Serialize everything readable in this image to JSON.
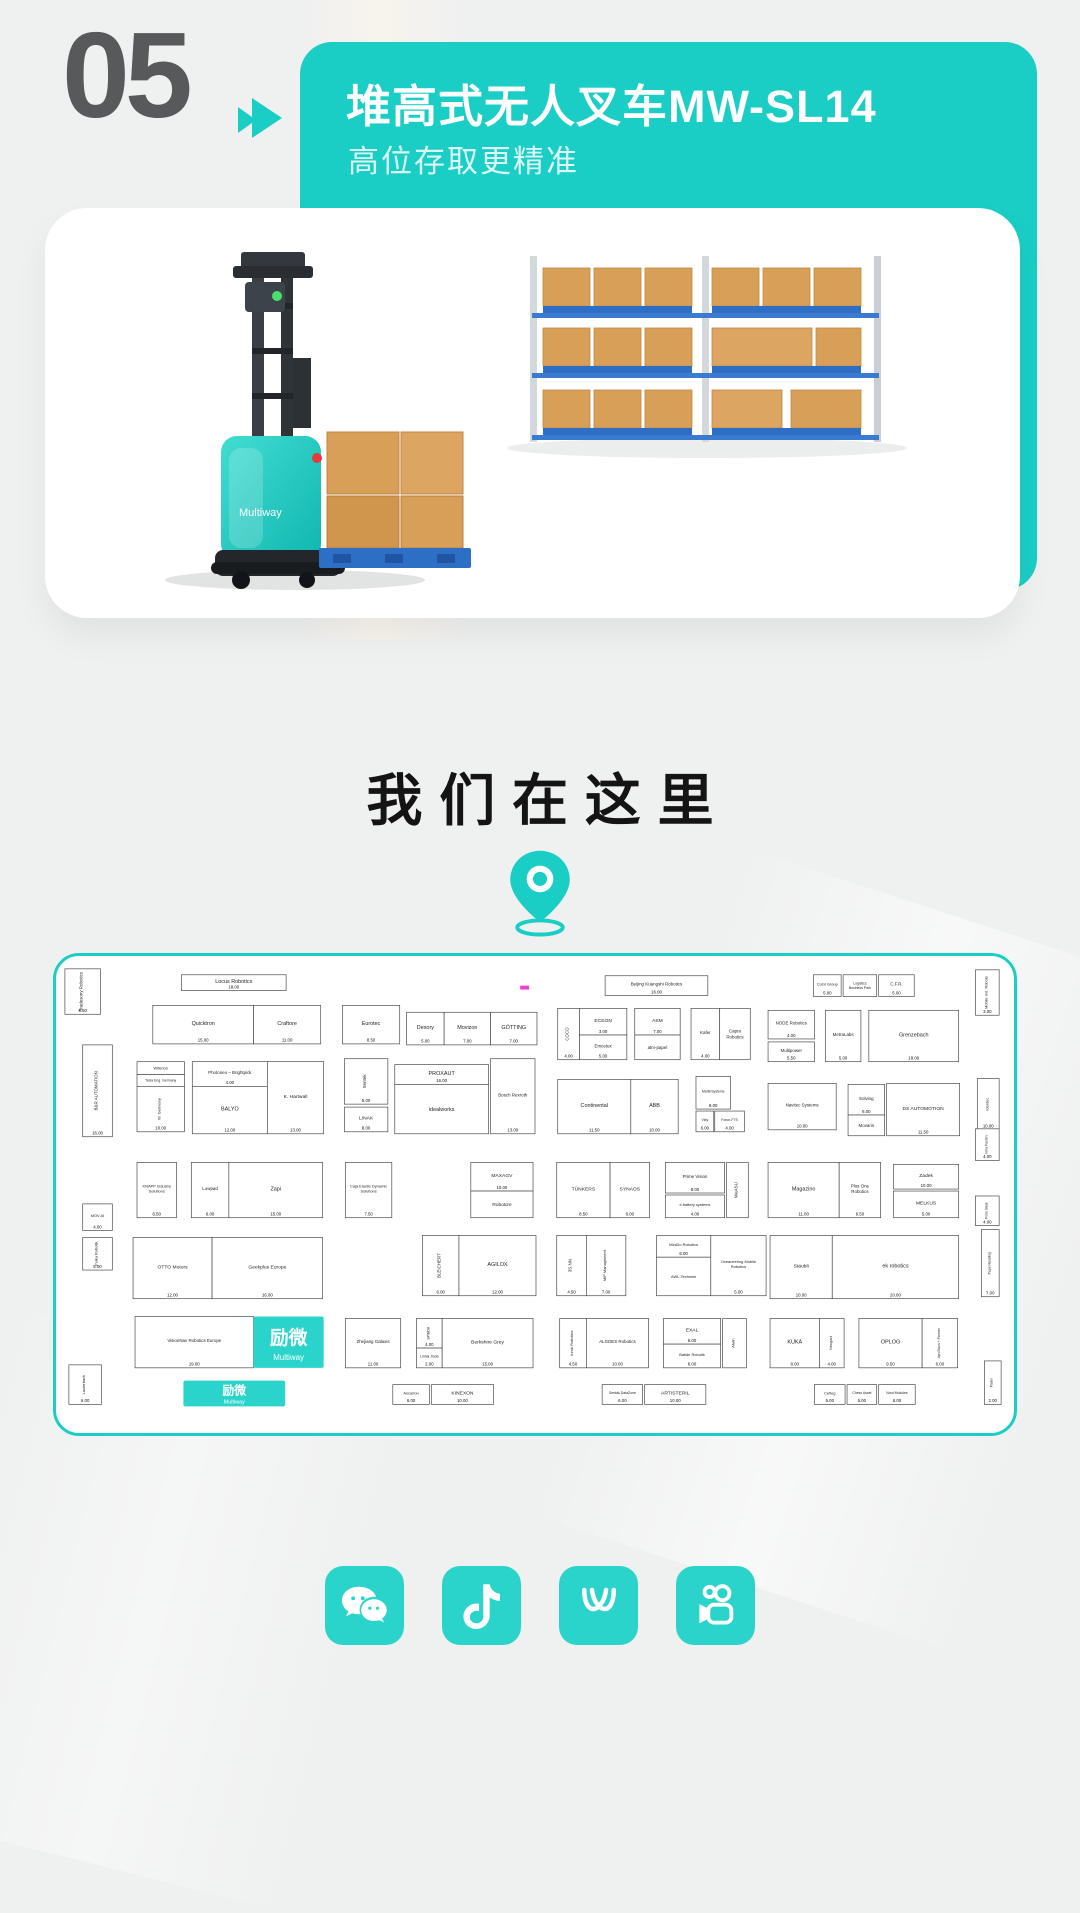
{
  "page": {
    "bg": "#eff0f0",
    "accent": "#1acec5",
    "accent_bright": "#2bd4cb"
  },
  "header": {
    "number": "05",
    "arrow_icon": "double-triangle-right",
    "title": "堆高式无人叉车MW-SL14",
    "subtitle": "高位存取更精准"
  },
  "product_card": {
    "brand": "Multiway",
    "scene": "teal stacker forklift carrying carton boxes on blue pallet beside pallet racking"
  },
  "location": {
    "heading": "我们在这里",
    "pin_icon": "location-pin"
  },
  "map": {
    "logo_cn": "励微",
    "logo_en": "Multiway",
    "pink_mark_color": "#f23fd0",
    "booths": [
      {
        "x": 6,
        "y": 13,
        "w": 36,
        "h": 46,
        "n": "Tradesony Robotics",
        "v": 1,
        "fs": 4.5,
        "d": "8.50"
      },
      {
        "x": 124,
        "y": 19,
        "w": 106,
        "h": 16,
        "n": "Locus Robotics",
        "d": "18.00",
        "fs": 5.5
      },
      {
        "x": 95,
        "y": 50,
        "w": 102,
        "h": 39,
        "n": "Quicktron",
        "d": "15.00"
      },
      {
        "x": 197,
        "y": 50,
        "w": 68,
        "h": 39,
        "n": "Craftore",
        "d": "11.00"
      },
      {
        "x": 287,
        "y": 50,
        "w": 58,
        "h": 39,
        "n": "Eurotec",
        "d": "8.50"
      },
      {
        "x": 352,
        "y": 57,
        "w": 38,
        "h": 33,
        "n": "Dexory",
        "d": "5.00"
      },
      {
        "x": 390,
        "y": 57,
        "w": 47,
        "h": 33,
        "n": "Movizon",
        "d": "7.00"
      },
      {
        "x": 437,
        "y": 57,
        "w": 47,
        "h": 33,
        "n": "GÖTTING",
        "d": "7.00"
      },
      {
        "x": 553,
        "y": 20,
        "w": 104,
        "h": 20,
        "n": "Beijing Kuangshi Robotics",
        "d": "16.00",
        "fs": 4.5
      },
      {
        "x": 505,
        "y": 53,
        "w": 22,
        "h": 52,
        "n": "COCO",
        "v": 1,
        "fs": 4.5,
        "d": "4.00"
      },
      {
        "x": 527,
        "y": 53,
        "w": 48,
        "h": 27,
        "n": "ECEON",
        "d": "3.00",
        "fs": 5
      },
      {
        "x": 527,
        "y": 80,
        "w": 48,
        "h": 25,
        "n": "Emcetex",
        "fs": 4.5,
        "d": "5.00"
      },
      {
        "x": 583,
        "y": 53,
        "w": 46,
        "h": 27,
        "n": "ASM",
        "d": "7.00",
        "fs": 5
      },
      {
        "x": 583,
        "y": 80,
        "w": 46,
        "h": 25,
        "n": "atm-papel",
        "fs": 4.5
      },
      {
        "x": 640,
        "y": 53,
        "w": 29,
        "h": 52,
        "n": "Kafer",
        "fs": 4.5,
        "d": "4.00"
      },
      {
        "x": 669,
        "y": 53,
        "w": 31,
        "h": 52,
        "n": "Capra Robotics",
        "fs": 4.5
      },
      {
        "x": 764,
        "y": 19,
        "w": 28,
        "h": 22,
        "n": "CoGi Group",
        "fs": 4,
        "d": "5.00"
      },
      {
        "x": 794,
        "y": 19,
        "w": 34,
        "h": 22,
        "n": "Logistics Business Park",
        "fs": 3.5
      },
      {
        "x": 830,
        "y": 19,
        "w": 36,
        "h": 22,
        "n": "C.F.R.",
        "fs": 4.5,
        "d": "5.00"
      },
      {
        "x": 928,
        "y": 14,
        "w": 24,
        "h": 46,
        "n": "Mobile Ind. Robots",
        "v": 1,
        "fs": 4,
        "d": "3.00"
      },
      {
        "x": 718,
        "y": 55,
        "w": 47,
        "h": 29,
        "n": "NODE Robotics",
        "fs": 4.5,
        "d": "4.00"
      },
      {
        "x": 718,
        "y": 87,
        "w": 47,
        "h": 20,
        "n": "Multipower",
        "fs": 4.5,
        "d": "5.50"
      },
      {
        "x": 776,
        "y": 55,
        "w": 36,
        "h": 52,
        "n": "MetraLabs",
        "fs": 4.5,
        "d": "5.00"
      },
      {
        "x": 820,
        "y": 55,
        "w": 91,
        "h": 52,
        "n": "Grenzebach",
        "d": "18.00"
      },
      {
        "x": 24,
        "y": 90,
        "w": 30,
        "h": 93,
        "n": "B&R AUTOMATION",
        "v": 1,
        "fs": 4.5,
        "d": "16.00"
      },
      {
        "x": 79,
        "y": 107,
        "w": 48,
        "h": 13,
        "n": "Wiferion",
        "fs": 4
      },
      {
        "x": 79,
        "y": 120,
        "w": 48,
        "h": 12,
        "n": "Tesla Eng. Germany",
        "fs": 3.5
      },
      {
        "x": 79,
        "y": 132,
        "w": 48,
        "h": 46,
        "n": "W. Germany",
        "v": 1,
        "fs": 4,
        "d": "10.00"
      },
      {
        "x": 135,
        "y": 107,
        "w": 76,
        "h": 25,
        "n": "Photoneo – Brightpick",
        "fs": 4.5,
        "d": "4.00"
      },
      {
        "x": 135,
        "y": 132,
        "w": 76,
        "h": 48,
        "n": "BALYO",
        "d": "12.00"
      },
      {
        "x": 211,
        "y": 107,
        "w": 57,
        "h": 73,
        "n": "K. Hartwall",
        "fs": 5,
        "d": "13.00"
      },
      {
        "x": 289,
        "y": 104,
        "w": 44,
        "h": 46,
        "n": "Sentek",
        "v": 1,
        "fs": 4.5,
        "d": "5.00"
      },
      {
        "x": 289,
        "y": 153,
        "w": 44,
        "h": 25,
        "n": "LINAK",
        "fs": 5,
        "d": "8.00"
      },
      {
        "x": 340,
        "y": 110,
        "w": 95,
        "h": 20,
        "n": "PROXAUT",
        "d": "16.00"
      },
      {
        "x": 340,
        "y": 130,
        "w": 95,
        "h": 50,
        "n": "idealworks"
      },
      {
        "x": 437,
        "y": 104,
        "w": 45,
        "h": 76,
        "n": "Bosch Rexroth",
        "fs": 4.5,
        "d": "13.00"
      },
      {
        "x": 505,
        "y": 125,
        "w": 74,
        "h": 55,
        "n": "Continental",
        "d": "11.50"
      },
      {
        "x": 579,
        "y": 125,
        "w": 48,
        "h": 55,
        "n": "ABB",
        "d": "10.00"
      },
      {
        "x": 645,
        "y": 122,
        "w": 35,
        "h": 33,
        "n": "MarlinSystems",
        "fs": 3.5,
        "d": "8.00"
      },
      {
        "x": 645,
        "y": 157,
        "w": 18,
        "h": 21,
        "n": "Vidy",
        "fs": 3.5,
        "d": "6.00"
      },
      {
        "x": 664,
        "y": 157,
        "w": 30,
        "h": 21,
        "n": "Forun-FTS",
        "fs": 3.5,
        "d": "4.00"
      },
      {
        "x": 718,
        "y": 129,
        "w": 69,
        "h": 47,
        "n": "Navitec Systems",
        "fs": 4.5,
        "d": "10.00"
      },
      {
        "x": 799,
        "y": 130,
        "w": 37,
        "h": 31,
        "n": "Solving",
        "fs": 4.5,
        "d": "6.00"
      },
      {
        "x": 799,
        "y": 161,
        "w": 37,
        "h": 21,
        "n": "Movaris",
        "fs": 4.5
      },
      {
        "x": 838,
        "y": 129,
        "w": 74,
        "h": 53,
        "n": "DS AUTOMOTION",
        "fs": 5,
        "d": "11.50"
      },
      {
        "x": 930,
        "y": 124,
        "w": 22,
        "h": 52,
        "n": "Identec",
        "v": 1,
        "fs": 4,
        "d": "10.00"
      },
      {
        "x": 24,
        "y": 251,
        "w": 30,
        "h": 27,
        "n": "MOV AI",
        "fs": 4,
        "d": "4.00"
      },
      {
        "x": 24,
        "y": 285,
        "w": 30,
        "h": 33,
        "n": "Pulka Robotik",
        "v": 1,
        "fs": 4,
        "d": "5.00"
      },
      {
        "x": 79,
        "y": 209,
        "w": 40,
        "h": 56,
        "n": "KNAPP Industry Solutions",
        "fs": 4,
        "d": "6.50"
      },
      {
        "x": 134,
        "y": 209,
        "w": 38,
        "h": 56,
        "n": "Lowpad",
        "fs": 4.5,
        "d": "6.00"
      },
      {
        "x": 172,
        "y": 209,
        "w": 95,
        "h": 56,
        "n": "Zapi",
        "d": "15.00"
      },
      {
        "x": 290,
        "y": 209,
        "w": 47,
        "h": 56,
        "n": "Caja Elastic Dynamic Solutions",
        "fs": 4,
        "d": "7.50"
      },
      {
        "x": 417,
        "y": 209,
        "w": 63,
        "h": 29,
        "n": "MAXAGV",
        "fs": 5,
        "d": "10.00"
      },
      {
        "x": 417,
        "y": 238,
        "w": 63,
        "h": 27,
        "n": "Robotize",
        "fs": 5
      },
      {
        "x": 504,
        "y": 209,
        "w": 54,
        "h": 56,
        "n": "TÜNKERS",
        "fs": 5,
        "d": "8.50"
      },
      {
        "x": 558,
        "y": 209,
        "w": 40,
        "h": 56,
        "n": "SYNAOS",
        "fs": 5,
        "d": "6.00"
      },
      {
        "x": 614,
        "y": 209,
        "w": 60,
        "h": 31,
        "n": "Prime Vision",
        "fs": 4.5,
        "d": "8.00"
      },
      {
        "x": 614,
        "y": 242,
        "w": 60,
        "h": 23,
        "n": "e.battery systems",
        "fs": 4,
        "d": "4.00"
      },
      {
        "x": 676,
        "y": 209,
        "w": 22,
        "h": 56,
        "n": "WeASU",
        "v": 1,
        "fs": 4.5
      },
      {
        "x": 718,
        "y": 209,
        "w": 72,
        "h": 56,
        "n": "Magazino",
        "d": "11.00"
      },
      {
        "x": 790,
        "y": 209,
        "w": 42,
        "h": 56,
        "n": "Plus One Robotics",
        "fs": 4.5,
        "d": "6.50"
      },
      {
        "x": 845,
        "y": 211,
        "w": 66,
        "h": 25,
        "n": "Zadek",
        "fs": 5,
        "d": "10.00"
      },
      {
        "x": 845,
        "y": 238,
        "w": 66,
        "h": 27,
        "n": "MELKUS",
        "fs": 5,
        "d": "5.00"
      },
      {
        "x": 928,
        "y": 175,
        "w": 24,
        "h": 32,
        "n": "Intra Fasten",
        "v": 1,
        "fs": 3.5,
        "d": "4.00"
      },
      {
        "x": 928,
        "y": 243,
        "w": 24,
        "h": 30,
        "n": "Frote Ideal",
        "v": 1,
        "fs": 3.5,
        "d": "4.00"
      },
      {
        "x": 934,
        "y": 277,
        "w": 18,
        "h": 68,
        "n": "Pape Handling",
        "v": 1,
        "fs": 3.5,
        "d": "7.00"
      },
      {
        "x": 75,
        "y": 285,
        "w": 80,
        "h": 62,
        "n": "OTTO Motors",
        "fs": 5,
        "d": "12.00"
      },
      {
        "x": 155,
        "y": 285,
        "w": 112,
        "h": 62,
        "n": "Geekplus Europe",
        "fs": 5,
        "d": "16.00"
      },
      {
        "x": 368,
        "y": 283,
        "w": 37,
        "h": 61,
        "n": "BLEICHERT",
        "v": 1,
        "fs": 4.5,
        "d": "6.00"
      },
      {
        "x": 405,
        "y": 283,
        "w": 78,
        "h": 61,
        "n": "AGILOX",
        "d": "12.00"
      },
      {
        "x": 504,
        "y": 283,
        "w": 30,
        "h": 61,
        "n": "3S NN",
        "v": 1,
        "fs": 4.5,
        "d": "4.50"
      },
      {
        "x": 534,
        "y": 283,
        "w": 40,
        "h": 61,
        "n": "MIP Management",
        "v": 1,
        "fs": 4,
        "d": "7.00"
      },
      {
        "x": 605,
        "y": 283,
        "w": 55,
        "h": 22,
        "n": "MiniDo Robotics",
        "fs": 4,
        "d": "6.00"
      },
      {
        "x": 605,
        "y": 305,
        "w": 55,
        "h": 39,
        "n": "AWL-Techniek",
        "fs": 4
      },
      {
        "x": 660,
        "y": 283,
        "w": 56,
        "h": 61,
        "n": "Oceaneering Mobile Robotics",
        "fs": 4,
        "d": "5.00"
      },
      {
        "x": 720,
        "y": 283,
        "w": 63,
        "h": 64,
        "n": "Stäubli",
        "fs": 5,
        "d": "10.00"
      },
      {
        "x": 783,
        "y": 283,
        "w": 128,
        "h": 64,
        "n": "ek robotics",
        "d": "20.00"
      },
      {
        "x": 10,
        "y": 414,
        "w": 33,
        "h": 40,
        "n": "Lauterbach",
        "v": 1,
        "fs": 4,
        "d": "6.00"
      },
      {
        "x": 77,
        "y": 365,
        "w": 120,
        "h": 52,
        "n": "VisionNav Robotics Europe",
        "fs": 4.5,
        "d": "19.00"
      },
      {
        "x": 197,
        "y": 365,
        "w": 71,
        "h": 52,
        "logo": "square"
      },
      {
        "x": 290,
        "y": 367,
        "w": 56,
        "h": 50,
        "n": "Zhejiang Galaxis",
        "fs": 4.5,
        "d": "11.00"
      },
      {
        "x": 362,
        "y": 367,
        "w": 26,
        "h": 30,
        "n": "SPINDA",
        "v": 1,
        "fs": 3.5,
        "d": "4.00"
      },
      {
        "x": 362,
        "y": 397,
        "w": 26,
        "h": 20,
        "n": "Linhai Jinda",
        "fs": 3.5,
        "d": "2.00"
      },
      {
        "x": 388,
        "y": 367,
        "w": 92,
        "h": 50,
        "n": "Berkshire Grey",
        "fs": 5,
        "d": "15.00"
      },
      {
        "x": 507,
        "y": 367,
        "w": 27,
        "h": 50,
        "n": "Inrok Robotics",
        "v": 1,
        "fs": 4,
        "d": "4.50"
      },
      {
        "x": 534,
        "y": 367,
        "w": 63,
        "h": 50,
        "n": "ALGDES Robotics",
        "fs": 4.5,
        "d": "10.00"
      },
      {
        "x": 612,
        "y": 367,
        "w": 58,
        "h": 26,
        "n": "EXAL",
        "fs": 5,
        "d": "6.00"
      },
      {
        "x": 612,
        "y": 393,
        "w": 58,
        "h": 24,
        "n": "Batide Robotik",
        "fs": 4,
        "d": "6.00"
      },
      {
        "x": 672,
        "y": 367,
        "w": 24,
        "h": 50,
        "n": "Aiwin",
        "v": 1,
        "fs": 4
      },
      {
        "x": 720,
        "y": 367,
        "w": 50,
        "h": 50,
        "n": "KUKA",
        "d": "8.00"
      },
      {
        "x": 770,
        "y": 367,
        "w": 25,
        "h": 50,
        "n": "Neugart",
        "v": 1,
        "fs": 4,
        "d": "4.00"
      },
      {
        "x": 810,
        "y": 367,
        "w": 64,
        "h": 50,
        "n": "OPLOG",
        "d": "9.50"
      },
      {
        "x": 874,
        "y": 367,
        "w": 36,
        "h": 50,
        "n": "dpn Daun + Partner",
        "v": 1,
        "fs": 3.5,
        "d": "6.00"
      },
      {
        "x": 338,
        "y": 434,
        "w": 37,
        "h": 20,
        "n": "Ascarion",
        "fs": 4,
        "d": "6.00"
      },
      {
        "x": 377,
        "y": 434,
        "w": 63,
        "h": 20,
        "n": "KINEXON",
        "fs": 5,
        "d": "10.00"
      },
      {
        "x": 550,
        "y": 434,
        "w": 41,
        "h": 20,
        "n": "Serdak DataZone",
        "fs": 3.5,
        "d": "6.00"
      },
      {
        "x": 593,
        "y": 434,
        "w": 62,
        "h": 20,
        "n": "ARTISTERIL",
        "fs": 5,
        "d": "10.00"
      },
      {
        "x": 765,
        "y": 434,
        "w": 31,
        "h": 20,
        "n": "Cefleg",
        "fs": 4,
        "d": "5.00"
      },
      {
        "x": 798,
        "y": 434,
        "w": 30,
        "h": 20,
        "n": "Chess Asset",
        "fs": 3.5,
        "d": "5.00"
      },
      {
        "x": 830,
        "y": 434,
        "w": 37,
        "h": 20,
        "n": "Nord Modules",
        "fs": 3.5,
        "d": "6.00"
      },
      {
        "x": 937,
        "y": 410,
        "w": 17,
        "h": 44,
        "n": "Pader",
        "v": 1,
        "fs": 3.5,
        "d": "2.00"
      },
      {
        "x": 126,
        "y": 430,
        "w": 103,
        "h": 26,
        "logo": "banner"
      }
    ],
    "marks": [
      {
        "x": 467,
        "y": 30,
        "w": 9,
        "h": 4,
        "c": "#f23fd0"
      }
    ]
  },
  "social": {
    "icons": [
      {
        "name": "wechat"
      },
      {
        "name": "douyin"
      },
      {
        "name": "wechat-channels"
      },
      {
        "name": "kuaishou"
      }
    ]
  }
}
